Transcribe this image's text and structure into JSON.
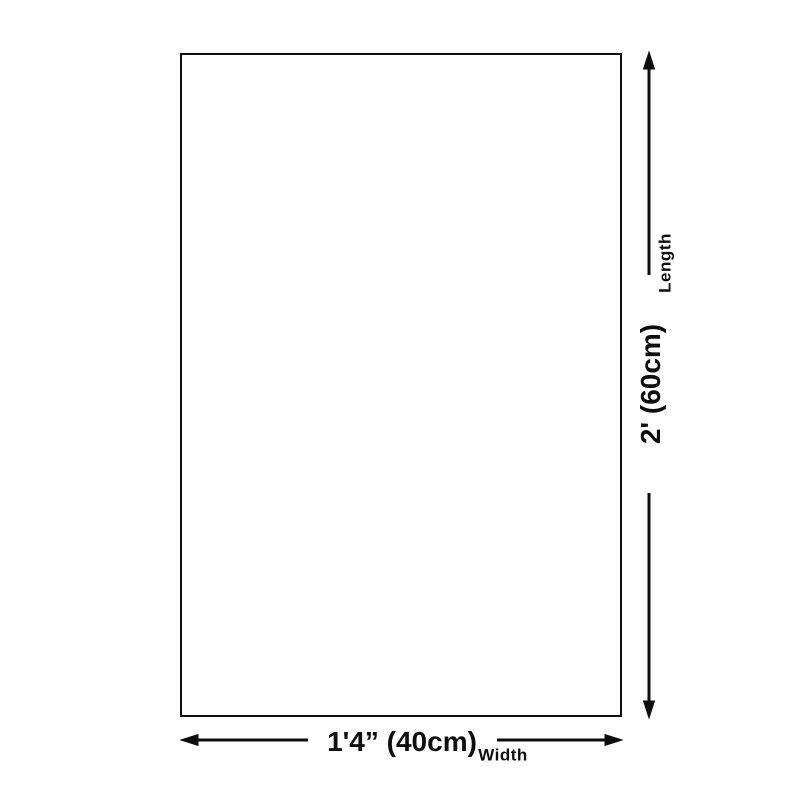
{
  "diagram": {
    "background_color": "#ffffff",
    "line_color": "#0d0d0d",
    "length": {
      "caption": "Length",
      "value": "2' (60cm)"
    },
    "width": {
      "caption": "Width",
      "value": "1'4” (40cm)"
    }
  }
}
